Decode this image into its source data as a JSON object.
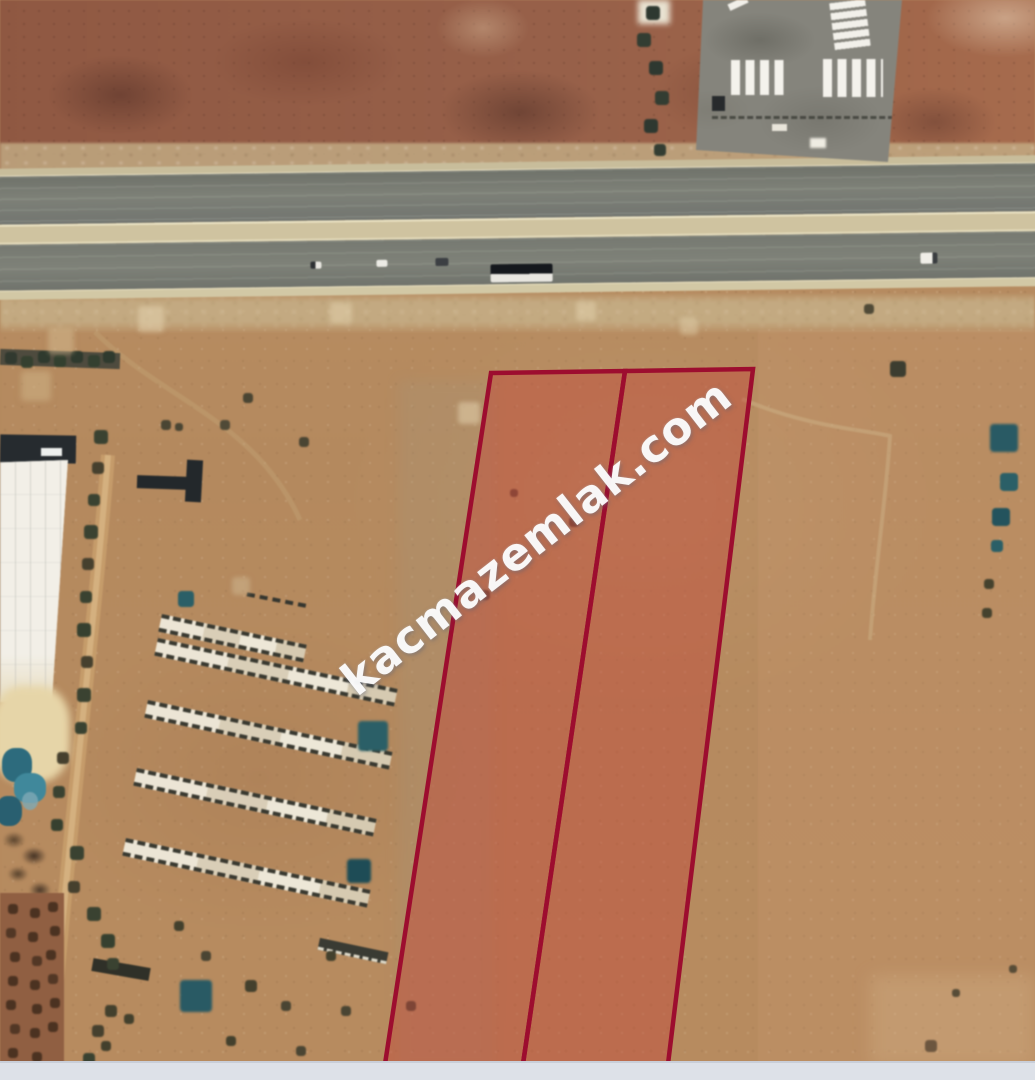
{
  "watermark": {
    "text": "kacmazemlak.com",
    "color": "#ffffff"
  },
  "map": {
    "type": "satellite-aerial",
    "theme_colors": {
      "terrain_tan": "#b3895f",
      "terrain_dark_red_field": "#935c44",
      "asphalt_road": "#767971",
      "road_median": "#cfc3a1",
      "parcel_border": "#9d0d2f",
      "parcel_fill": "rgba(195,62,52,0.40)",
      "water_tarp_teal": "#2e6b7c",
      "bottom_bar": "#dde1e8"
    },
    "overlay": {
      "parcels": [
        {
          "id": "parcel-1",
          "points": "491,373 625,371 523,1064 385,1064"
        },
        {
          "id": "parcel-2",
          "points": "625,371 753,369 668,1064 523,1064"
        }
      ],
      "stroke_width": 4.5
    },
    "features": [
      "divided-highway-with-vehicles",
      "truck-parking-lot",
      "greenhouse-building",
      "barn-ruin-rows",
      "orchard-grid",
      "dirt-road",
      "scattered-trees",
      "outlined-land-parcels"
    ]
  }
}
